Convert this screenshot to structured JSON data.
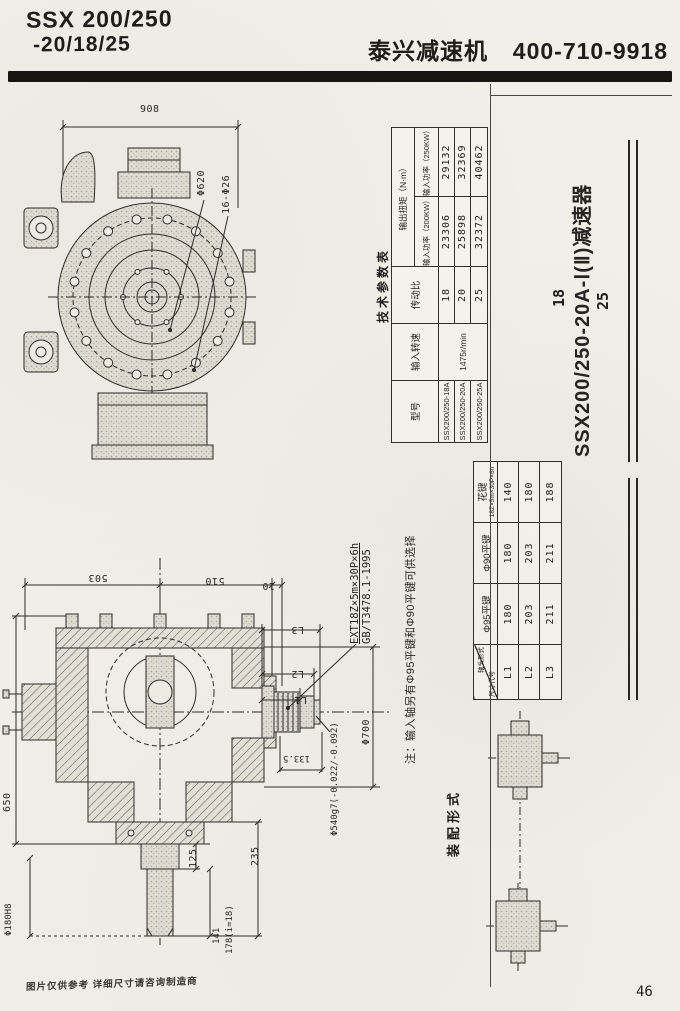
{
  "header": {
    "model_line1": "SSX 200/250",
    "model_line2": "-20/18/25",
    "brand": "泰兴减速机",
    "phone": "400-710-9918"
  },
  "side": {
    "ratio_top": "18",
    "model_vertical": "SSX200/250-20A-Ⅰ(Ⅱ)减速器",
    "ratio_bottom": "25",
    "assembly_label": "装配形式"
  },
  "params_table": {
    "title": "技术参数表",
    "col_model": "型号",
    "col_speed": "输入转速",
    "col_ratio": "传动比",
    "col_torque": "输出扭矩（N·m）",
    "col_p200": "输入功率（200KW）",
    "col_p250": "输入功率（250KW）",
    "speed_value": "1475r/min",
    "rows": [
      {
        "model": "SSX200/250-18A",
        "ratio": "18",
        "t200": "23306",
        "t250": "29132"
      },
      {
        "model": "SSX200/250-20A",
        "ratio": "20",
        "t200": "25898",
        "t250": "32369"
      },
      {
        "model": "SSX200/250-25A",
        "ratio": "25",
        "t200": "32372",
        "t250": "40462"
      }
    ]
  },
  "shaft_table": {
    "diag_top": "轴头形式",
    "diag_bottom": "尺寸代号",
    "col1": "Φ95平键",
    "col2": "Φ90平键",
    "col3": "花键",
    "col3_sub": "18Z×5m×30P×6h",
    "rows": [
      {
        "code": "L1",
        "v1": "180",
        "v2": "180",
        "v3": "140"
      },
      {
        "code": "L2",
        "v1": "203",
        "v2": "203",
        "v3": "180"
      },
      {
        "code": "L3",
        "v1": "211",
        "v2": "211",
        "v3": "188"
      }
    ]
  },
  "notes": {
    "spline_callout_line1": "EXT18Z×5m×30P×6h",
    "spline_callout_line2": "GB/T3478.1-1995",
    "input_shaft_note": "注：输入轴另有Φ95平键和Φ90平键可供选择"
  },
  "top_view_dims": {
    "overall_width": "908",
    "bolt_circle": "Φ620",
    "bolt_holes": "16-Φ26"
  },
  "section_dims": {
    "d503": "503",
    "d510": "510",
    "d10": "10",
    "L1": "L1",
    "L2": "L2",
    "L3": "L3",
    "shaft_tol": "Φ540g7(-0.022/-0.092)",
    "flange_od": "Φ700",
    "d133_5": "133.5",
    "height": "650",
    "d125": "125",
    "d235": "235",
    "d141": "141",
    "d178": "178(i=18)",
    "bottom_shaft": "Φ180H8"
  },
  "footer": {
    "disclaimer": "图片仅供参考  详细尺寸请咨询制造商",
    "page_number": "46"
  }
}
